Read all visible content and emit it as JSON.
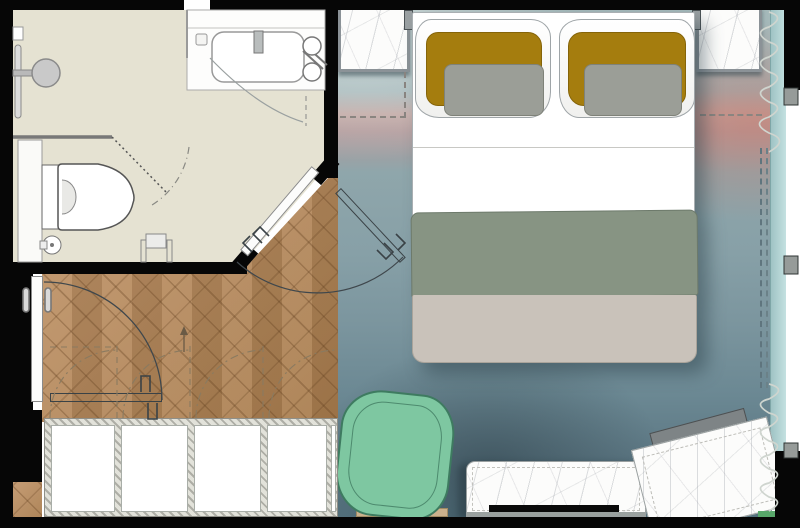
{
  "plan": {
    "type": "hotel-guestroom-floor-plan",
    "rooms": [
      {
        "name": "bathroom",
        "floor": "stone-beige",
        "fixtures": [
          "rain-shower-head",
          "shower-grab-bar",
          "shower-partition",
          "pivot-glass-screen",
          "bathtub",
          "tub-faucet",
          "tub-mixer-knobs",
          "hand-shower-rail",
          "wall-hung-toilet",
          "floor-drain",
          "shower-stool",
          "wall-niche"
        ]
      },
      {
        "name": "entry-hall",
        "floor": "herringbone-oak",
        "fixtures": [
          "entry-door-closed",
          "entry-door-open-outline",
          "door-swing-arc",
          "wardrobe-four-panel",
          "wardrobe-door-swings",
          "direction-arrow"
        ]
      },
      {
        "name": "bedroom",
        "floor": "dip-dye-area-rug",
        "furniture": [
          "double-bed",
          "pillow-left",
          "pillow-right",
          "gold-cushion-left",
          "gold-cushion-right",
          "gray-cushion-left",
          "gray-cushion-right",
          "sage-throw",
          "greige-runner",
          "nightstand-left",
          "nightstand-right",
          "reading-sconce-left",
          "reading-sconce-right",
          "tv-console-marble",
          "television",
          "desk-marble-angled",
          "desk-bench",
          "lounge-chair-green",
          "chair-mat",
          "bath-door-diagonal",
          "bath-door-open-outline"
        ]
      },
      {
        "name": "window-wall",
        "fixtures": [
          "curtain-coil-top",
          "curtain-coil-bottom",
          "curtain-track-dashed",
          "glazing-strip",
          "mullion-top",
          "mullion-middle",
          "mullion-bottom"
        ]
      }
    ]
  },
  "colors": {
    "wall": "#060606",
    "bathroomFloor": "#e5e2d2",
    "wood": "#b5885a",
    "carpetTop": "#a6babb",
    "carpetBottom": "#53707c",
    "carpetBlush": "#c79f9a",
    "marble": "#fcfcfb",
    "bedSheet": "#ffffff",
    "cushionGold": "#a57d0e",
    "cushionGray": "#9b9e97",
    "throwSage": "#879483",
    "runnerGreige": "#c9c2ba",
    "chairGreen": "#7ec7a1",
    "chairLine": "#4d8a6e",
    "glass": "#b7d8d8",
    "curtain": "#cfd5cf",
    "swingArc": "#3f474c",
    "closetArc": "#8a7a60",
    "fixtureLine": "#777777"
  }
}
